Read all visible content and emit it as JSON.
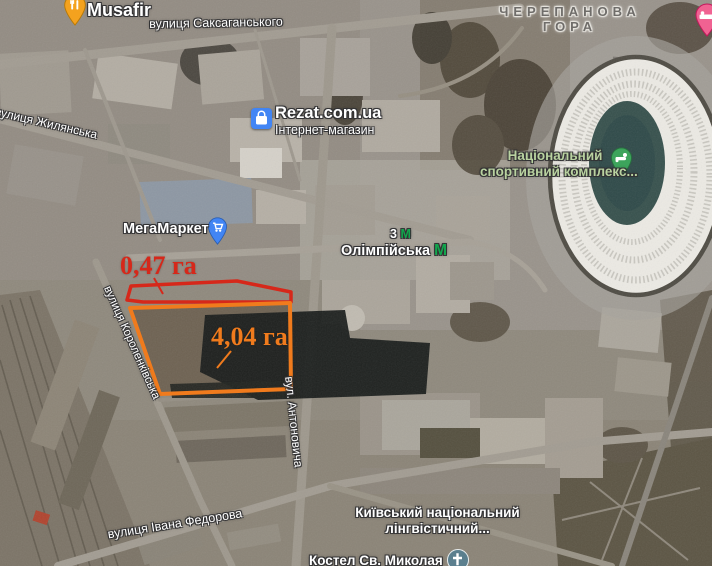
{
  "map": {
    "kind": "satellite",
    "pois": {
      "musafir": {
        "name": "Musafir"
      },
      "rezat": {
        "name": "Rezat.com.ua",
        "subtitle": "Інтернет-магазин"
      },
      "megamarket": {
        "name": "МегаМаркет"
      },
      "sports_complex": {
        "name_line1": "Національний",
        "name_line2": "спортивний комплекс..."
      },
      "linguistic_university": {
        "name_line1": "Київський національний",
        "name_line2": "лінгвістичний..."
      },
      "church": {
        "name": "Костел Св. Миколая"
      },
      "metro_station": {
        "name": "Олімпійська",
        "metro_letter": "М"
      },
      "metro_entrance": {
        "number": "3",
        "metro_letter": "М"
      }
    },
    "streets": {
      "saksahanskoho": "вулиця Саксаганського",
      "zhylianska": "вулиця Жилянська",
      "korolenkivska": "вулиця Короленківська",
      "antonovycha": "вул. Антоновича",
      "ivana_fedorova": "вулиця Івана Федорова"
    },
    "districts": {
      "cherepanova_line1": "ЧЕРЕПАНОВА",
      "cherepanova_line2": "ГОРА"
    },
    "measurements": {
      "red_area": {
        "label": "0,47 га",
        "color": "#d6281a"
      },
      "orange_area": {
        "label": "4,04 га",
        "color": "#f07b1d"
      }
    },
    "colors": {
      "metro_green": "#12a64d",
      "pin_blue": "#4285f4",
      "pin_amber": "#f4a21e",
      "pin_green": "#3da45c",
      "pin_pink": "#f06292",
      "church_teal": "#5b7f8e"
    }
  }
}
